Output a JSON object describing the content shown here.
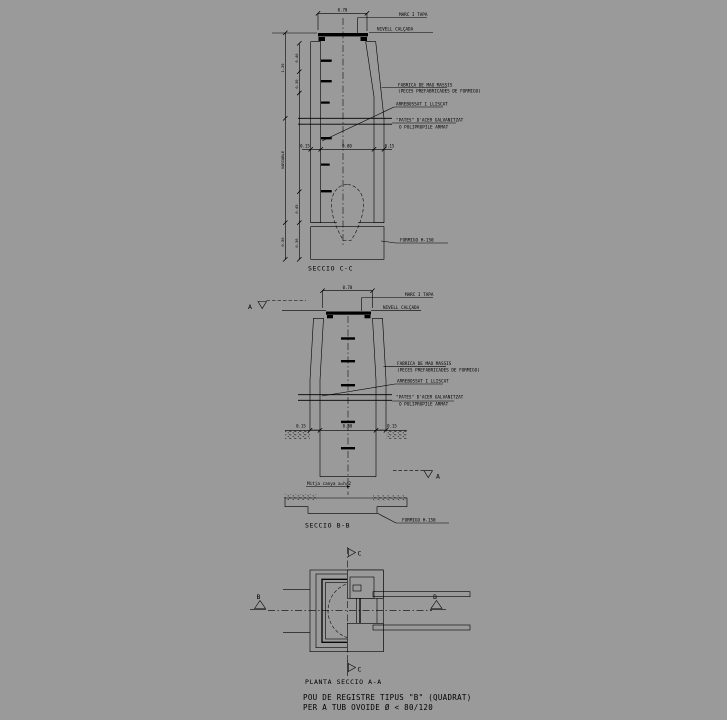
{
  "background_color": "#9a9a9a",
  "ink_color": "#000000",
  "title_block": {
    "line1": "POU DE REGISTRE TIPUS \"B\" (QUADRAT)",
    "line2": "PER A TUB OVOIDE Ø < 80/120"
  },
  "seccio_cc": {
    "caption": "SECCIO C-C",
    "labels": {
      "marc_tapa": "MARC I TAPA",
      "nivell_calcada": "NIVELL CALÇADA",
      "fabrica_line1": "FABRICA DE MAO MASSIS",
      "fabrica_line2": "(PECES PREFABRICADES DE FORMIGO)",
      "arrebossat": "ARREBOSSAT I LLISCAT",
      "pates_line1": "\"PATES\" D'ACER GALVANITZAT",
      "pates_line2": "O POLIPROPILE ARMAT",
      "formigo": "FORMIGO H-150"
    },
    "dims": {
      "top_width": "0.70",
      "wall_left": "0.15",
      "inner_width": "0.80",
      "wall_right": "0.15",
      "left_outer_top": "1.20",
      "left_outer_mid": "VARIABLE",
      "left_outer_bottom": "0.50",
      "left_inner_1": "0.40",
      "left_inner_2": "0.30",
      "left_inner_3": "0.45",
      "left_inner_4": "0.30"
    }
  },
  "seccio_bb": {
    "caption": "SECCIO B-B",
    "labels": {
      "marc_tapa": "MARC I TAPA",
      "nivell_calcada": "NIVELL CALÇADA",
      "fabrica_line1": "FABRICA DE MAO MASSIS",
      "fabrica_line2": "(PECES PREFABRICADES DE FORMIGO)",
      "arrebossat": "ARREBOSSAT I LLISCAT",
      "pates_line1": "\"PATES\" D'ACER GALVANITZAT",
      "pates_line2": "O POLIPROPILE ARMAT",
      "mitja_canya": "Mitja canya a=h/2",
      "formigo": "FORMIGO H-150"
    },
    "dims": {
      "top_width": "0.70",
      "wall_left": "0.15",
      "inner_width": "0.80",
      "wall_right": "0.15"
    },
    "section_marker": "A"
  },
  "planta": {
    "caption": "PLANTA SECCIO A-A",
    "marker_b": "B",
    "marker_c": "C"
  }
}
